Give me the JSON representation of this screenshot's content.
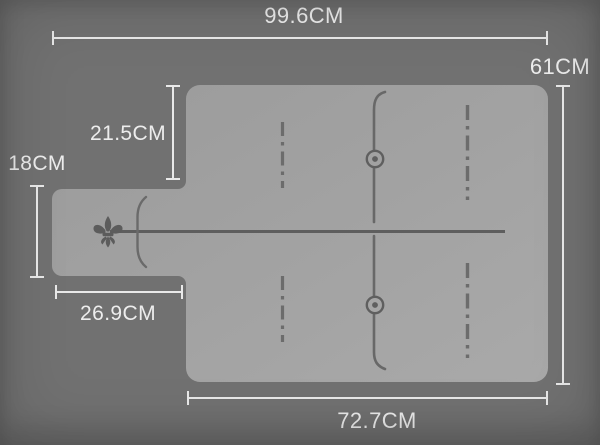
{
  "dim_labels": {
    "top_width": "99.6CM",
    "right_height": "61CM",
    "upper_left_inset": "21.5CM",
    "lip_height": "18CM",
    "lip_width": "26.9CM",
    "bottom_width": "72.7CM"
  },
  "icons": {
    "fleur_de_lis": "⚜",
    "target_ring": "◎"
  },
  "colors": {
    "background": "#717171",
    "mat_fill_light": "#a8a8a8",
    "mat_fill_dark": "#9b9b9b",
    "marking": "#656565",
    "dimension_line": "#e9e9e9",
    "dimension_text": "#ededed"
  }
}
